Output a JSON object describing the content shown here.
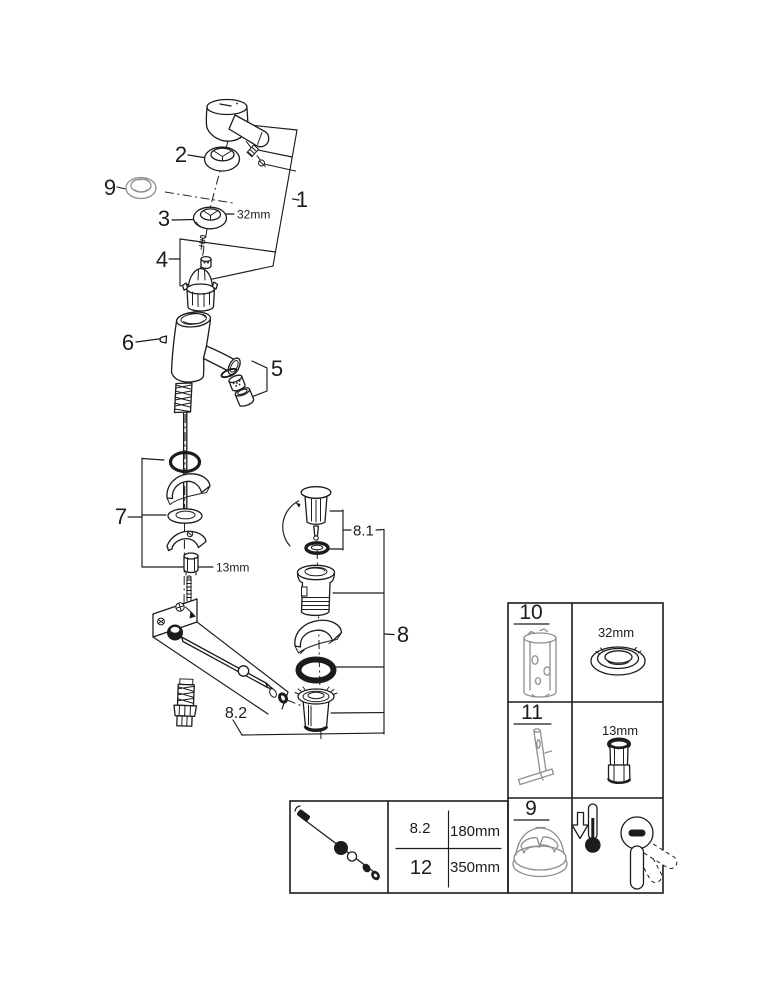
{
  "diagram": {
    "callouts": {
      "c1": "1",
      "c2": "2",
      "c3": "3",
      "c4": "4",
      "c5": "5",
      "c6": "6",
      "c7": "7",
      "c8": "8",
      "c9": "9",
      "c8_1": "8.1",
      "c8_2": "8.2"
    },
    "dimensions": {
      "escutcheon_ring": "32mm",
      "mounting_nut": "13mm"
    },
    "icons": [
      "lever-handle",
      "handle-ring",
      "temperature-limiter",
      "escutcheon-ring",
      "cartridge",
      "faucet-body",
      "aerator",
      "mounting-set",
      "pull-rod",
      "pop-up-plug",
      "drain-flange",
      "drain-wedge",
      "drain-o-ring",
      "drain-cup",
      "rotation-arrow"
    ]
  },
  "accessory_table": {
    "rows": [
      {
        "num": "10",
        "dim": "32mm",
        "icon": "cartridge-removal-tool-icon"
      },
      {
        "num": "11",
        "dim": "13mm",
        "icon": "mounting-wrench-tool-icon"
      },
      {
        "num": "9",
        "dim": "",
        "icon": "temperature-limiter-icon"
      }
    ],
    "row3_icons": [
      "cold-thermometer-icon",
      "lever-rotation-icon"
    ]
  },
  "rod_table": {
    "icon": "pop-up-rod-icon",
    "rows": [
      {
        "num": "8.2",
        "dim": "180mm"
      },
      {
        "num": "12",
        "dim": "350mm"
      }
    ]
  },
  "colors": {
    "line": "#1c1c1c",
    "muted_gray": "#9a9a9a",
    "background": "#ffffff"
  }
}
